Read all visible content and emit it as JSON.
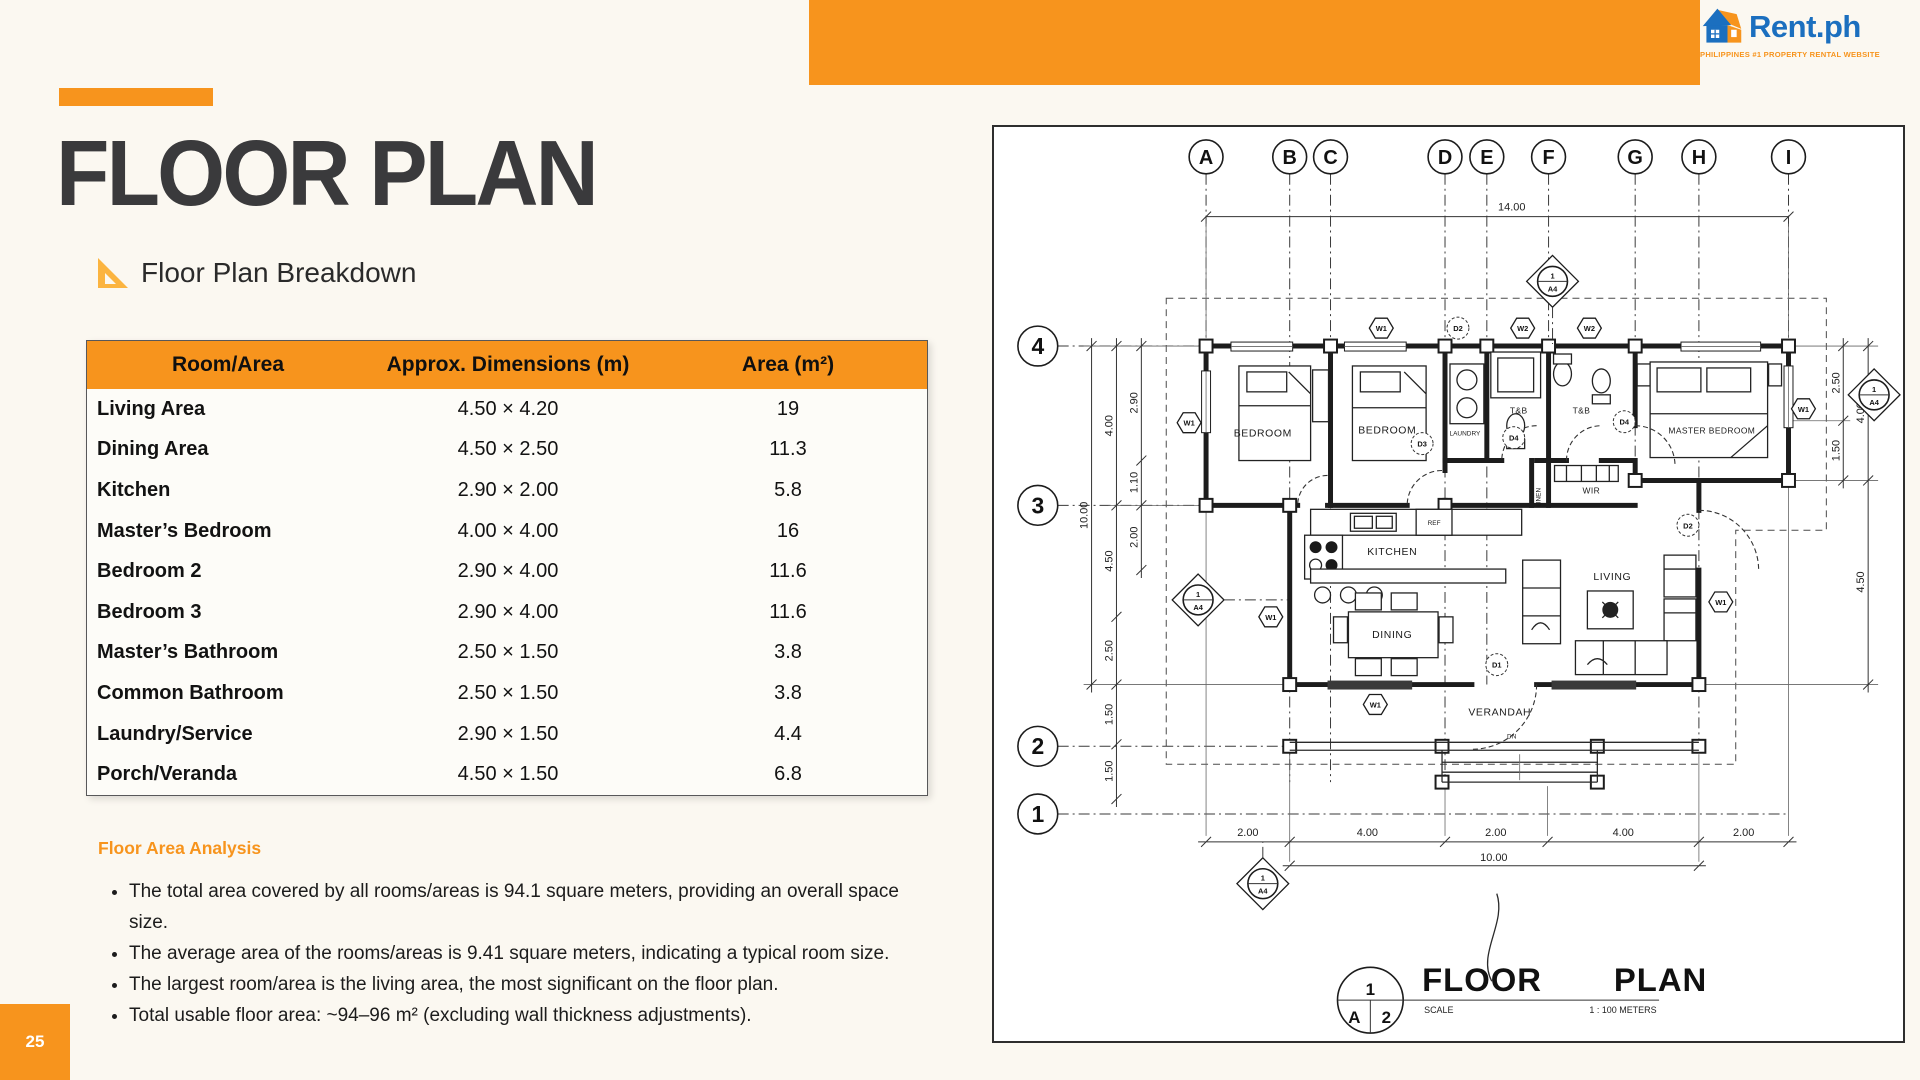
{
  "page": {
    "number": "25",
    "title": "FLOOR PLAN",
    "subtitle": "Floor Plan Breakdown"
  },
  "logo": {
    "name": "Rent.ph",
    "tagline": "PHILIPPINES #1 PROPERTY RENTAL WEBSITE"
  },
  "colors": {
    "accent": "#F7941D",
    "logo_blue": "#1B6FBF",
    "title_text": "#3A3A3C"
  },
  "table": {
    "headers": [
      "Room/Area",
      "Approx. Dimensions (m)",
      "Area (m²)"
    ],
    "rows": [
      {
        "room": "Living Area",
        "dims": "4.50 × 4.20",
        "area": "19"
      },
      {
        "room": "Dining Area",
        "dims": "4.50 × 2.50",
        "area": "11.3"
      },
      {
        "room": "Kitchen",
        "dims": "2.90 × 2.00",
        "area": "5.8"
      },
      {
        "room": "Master’s Bedroom",
        "dims": "4.00 × 4.00",
        "area": "16"
      },
      {
        "room": "Bedroom 2",
        "dims": "2.90 × 4.00",
        "area": "11.6"
      },
      {
        "room": "Bedroom 3",
        "dims": "2.90 × 4.00",
        "area": "11.6"
      },
      {
        "room": "Master’s Bathroom",
        "dims": "2.50 × 1.50",
        "area": "3.8"
      },
      {
        "room": "Common Bathroom",
        "dims": "2.50 × 1.50",
        "area": "3.8"
      },
      {
        "room": "Laundry/Service",
        "dims": "2.90 × 1.50",
        "area": "4.4"
      },
      {
        "room": "Porch/Veranda",
        "dims": "4.50 × 1.50",
        "area": "6.8"
      }
    ]
  },
  "analysis": {
    "heading": "Floor Area Analysis",
    "bullets": [
      "The total area covered by all rooms/areas is 94.1 square meters, providing an overall space size.",
      "The average area of the rooms/areas is 9.41 square meters, indicating a typical room size.",
      "The largest room/area is the living area, the most significant on the floor plan.",
      "Total usable floor area: ~94–96 m² (excluding wall thickness adjustments)."
    ]
  },
  "floor_plan": {
    "grid_cols": [
      "A",
      "B",
      "C",
      "D",
      "E",
      "F",
      "G",
      "H",
      "I"
    ],
    "grid_rows": [
      "4",
      "3",
      "2",
      "1"
    ],
    "rooms": {
      "bedroom": "BEDROOM",
      "master_bedroom": "MASTER BEDROOM",
      "laundry": "LAUNDRY",
      "tb": "T&B",
      "linen": "LINEN",
      "wir": "WIR",
      "kitchen": "KITCHEN",
      "ref": "REF",
      "dining": "DINING",
      "living": "LIVING",
      "verandah": "VERANDAH",
      "dn": "DN"
    },
    "markers": {
      "w1": "W1",
      "w2": "W2",
      "d1": "D1",
      "d2": "D2",
      "d3": "D3",
      "d4": "D4"
    },
    "a4": {
      "top": "1",
      "bottom": "A4"
    },
    "dims": {
      "top": "14.00",
      "left_outer": "10.00",
      "left_mid": [
        "4.00",
        "4.50",
        "2.50",
        "1.50",
        "1.50"
      ],
      "left_inner": [
        "2.90",
        "1.10",
        "2.00"
      ],
      "right_inner": [
        "2.50",
        "1.50"
      ],
      "right_outer": [
        "4.00",
        "4.50"
      ],
      "bottom": [
        "2.00",
        "4.00",
        "2.00",
        "4.00",
        "2.00"
      ],
      "bottom_total": "10.00"
    },
    "title_block": {
      "number": "1",
      "sheet": "A",
      "page": "2",
      "title": "FLOOR PLAN",
      "scale_label": "SCALE",
      "scale_value": "1 : 100 METERS"
    }
  }
}
